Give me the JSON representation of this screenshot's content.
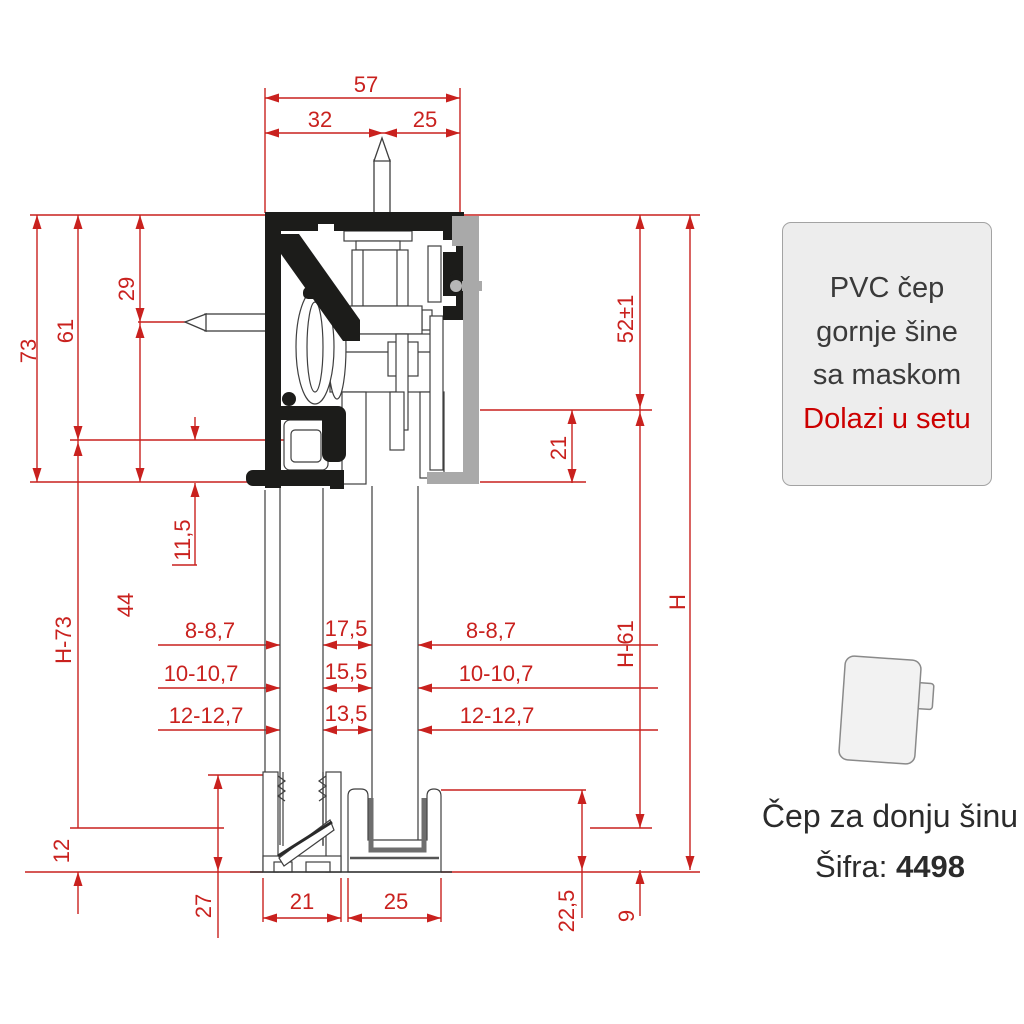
{
  "colors": {
    "dimension_red": "#c9211e",
    "profile_black": "#1c1c1a",
    "cover_gray": "#a9a9a9",
    "note_red": "#cc0000"
  },
  "dimensions": {
    "top": {
      "total": "57",
      "left": "32",
      "right": "25"
    },
    "left": {
      "outer_height": "73",
      "inner_height": "61",
      "screw_top": "29",
      "screw_bottom": "44",
      "channel_depth": "11,5",
      "door": "H-73",
      "clearance": "12",
      "guide_height": "27"
    },
    "glass": {
      "rows": [
        {
          "left": "8-8,7",
          "gap": "17,5",
          "right": "8-8,7"
        },
        {
          "left": "10-10,7",
          "gap": "15,5",
          "right": "10-10,7"
        },
        {
          "left": "12-12,7",
          "gap": "13,5",
          "right": "12-12,7"
        }
      ]
    },
    "right": {
      "hanger": "52±1",
      "gap": "21",
      "door": "H-61",
      "total": "H",
      "guide_height": "22,5",
      "floor_gap": "9"
    },
    "bottom": {
      "left_guide": "21",
      "right_guide": "25"
    }
  },
  "info_box": {
    "line1": "PVC čep",
    "line2": "gornje šine",
    "line3": "sa maskom",
    "note": "Dolazi u setu"
  },
  "caption": {
    "title": "Čep za donju šinu",
    "code_label": "Šifra:",
    "code_value": "4498"
  }
}
